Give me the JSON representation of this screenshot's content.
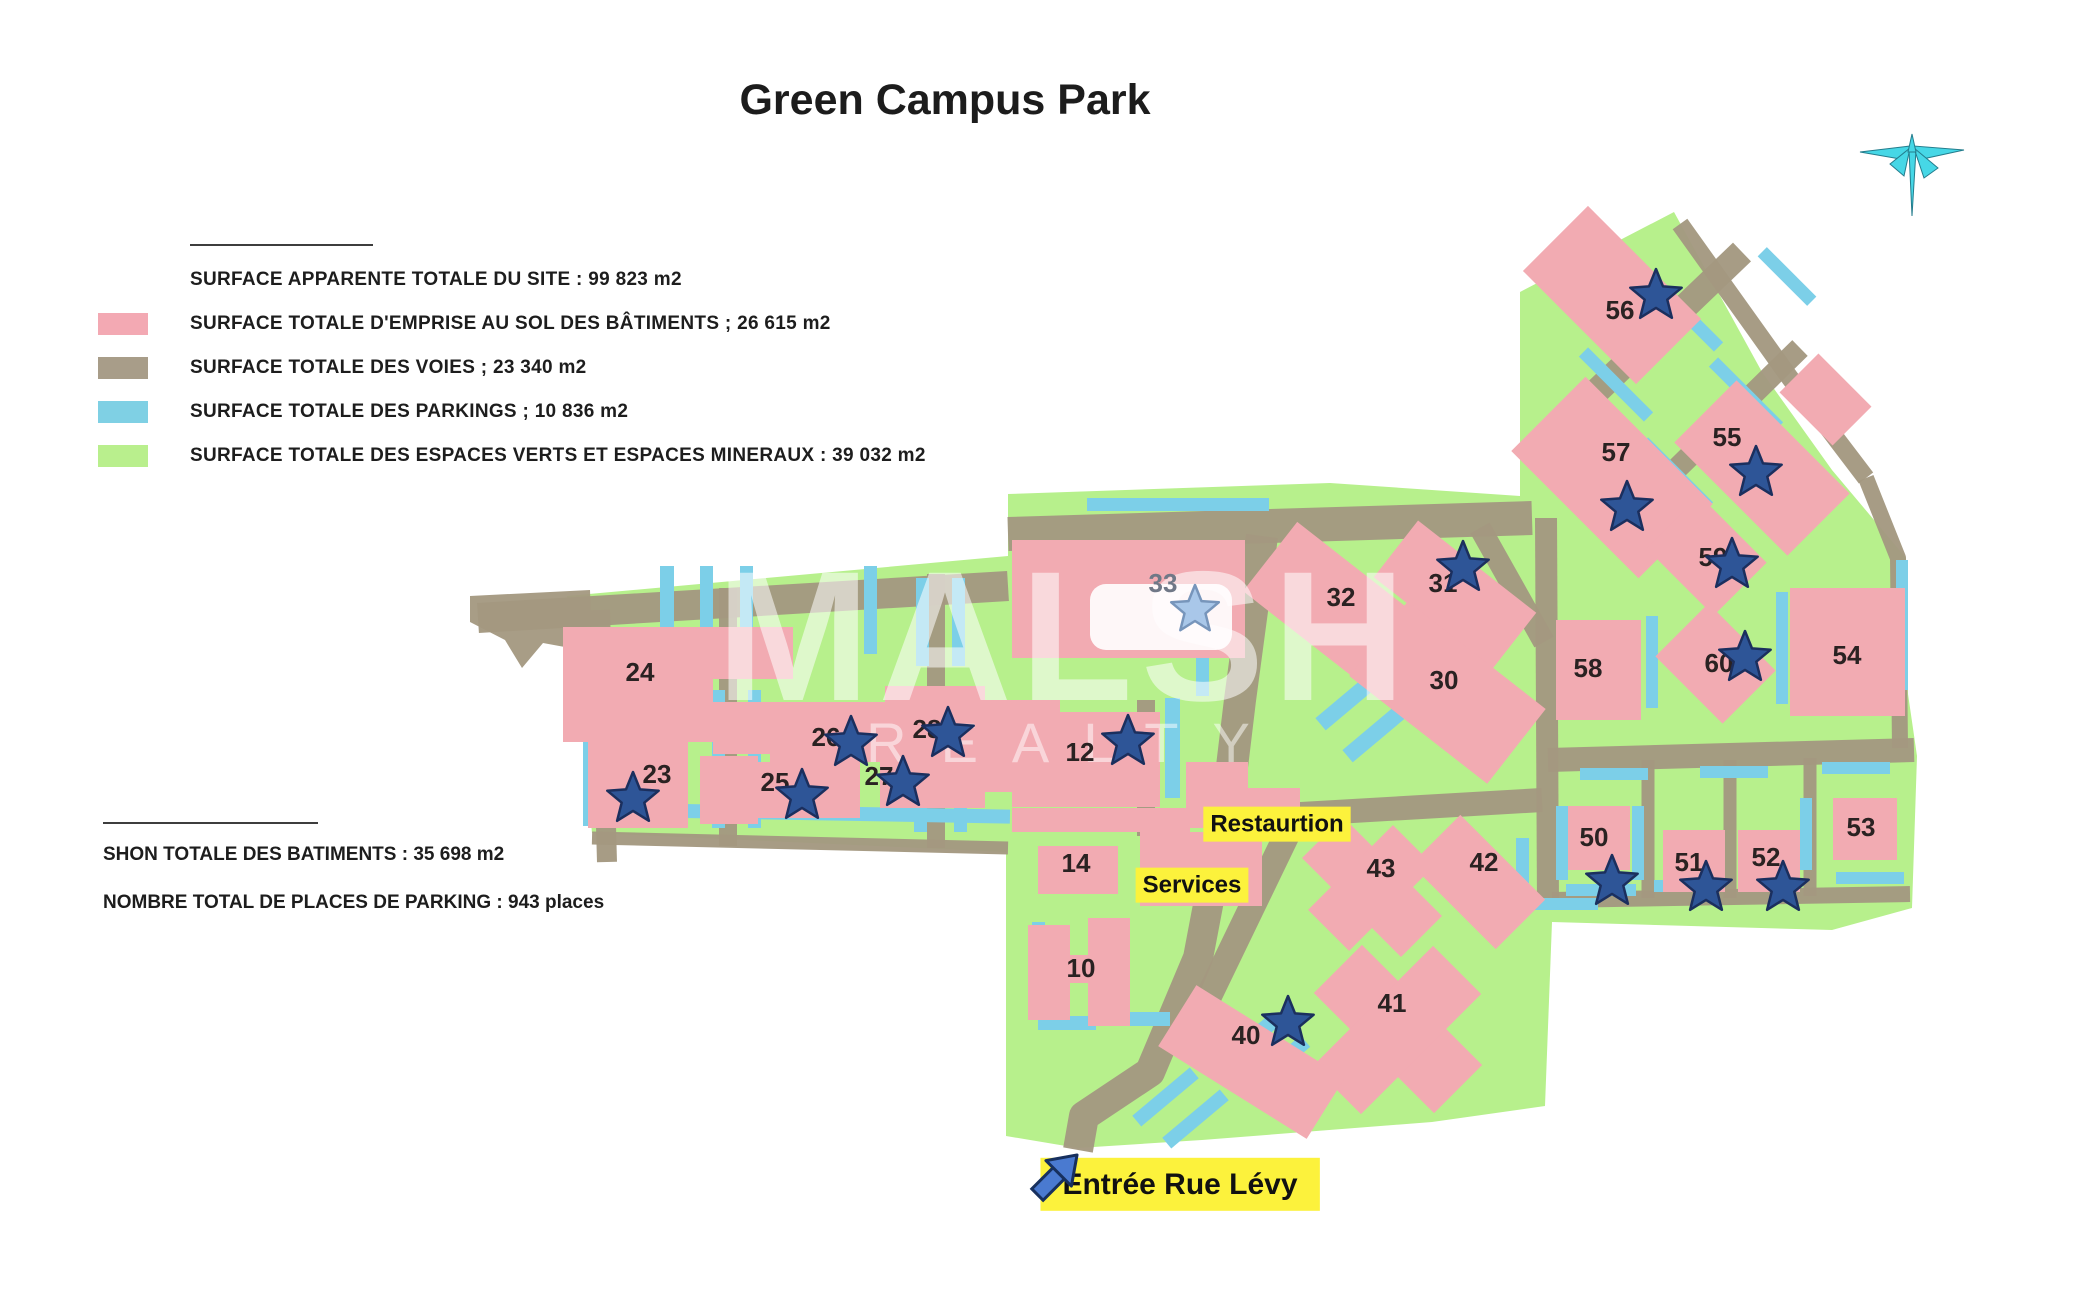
{
  "title": "Green Campus Park",
  "legend": {
    "site": "SURFACE APPARENTE TOTALE DU SITE : 99 823 m2",
    "items": [
      {
        "color": "#f3a9b3",
        "label": "SURFACE TOTALE D'EMPRISE AU SOL DES BÂTIMENTS ; 26 615  m2"
      },
      {
        "color": "#a89d89",
        "label": "SURFACE TOTALE DES VOIES ; 23 340  m2"
      },
      {
        "color": "#7fd0e4",
        "label": "SURFACE TOTALE DES PARKINGS ; 10 836  m2"
      },
      {
        "color": "#b9ef8d",
        "label": "SURFACE TOTALE DES ESPACES VERTS ET ESPACES MINERAUX : 39 032  m2"
      }
    ]
  },
  "stats": {
    "shon": "SHON TOTALE DES BATIMENTS : 35 698 m2",
    "parking": "NOMBRE TOTAL DE PLACES DE PARKING : 943 places"
  },
  "watermark": {
    "line1": "MALSH",
    "line2": "REALTY"
  },
  "map": {
    "colors": {
      "green": "#b7f08c",
      "road": "#a39880",
      "building": "#f2abb2",
      "parking": "#7ccfe8",
      "star": "#2e5597",
      "star_stroke": "#1b2f5e",
      "star_light": "#a9c7e9",
      "star_light_stroke": "#7795bb",
      "tag_bg": "#fcf23c",
      "tag_text": "#111111",
      "label_text": "#2a2222",
      "label_muted": "#707887",
      "arrow": "#4a7ad0",
      "arrow_stroke": "#17305e",
      "compass": "#46d7e6",
      "compass_stroke": "#237c8c"
    },
    "green_outline": [
      [
        567,
        596
      ],
      [
        1008,
        556
      ],
      [
        1008,
        494
      ],
      [
        1330,
        483
      ],
      [
        1520,
        496
      ],
      [
        1520,
        292
      ],
      [
        1674,
        212
      ],
      [
        1762,
        372
      ],
      [
        1832,
        470
      ],
      [
        1906,
        558
      ],
      [
        1908,
        694
      ],
      [
        1917,
        756
      ],
      [
        1912,
        908
      ],
      [
        1832,
        930
      ],
      [
        1552,
        922
      ],
      [
        1545,
        1106
      ],
      [
        1432,
        1122
      ],
      [
        1202,
        1140
      ],
      [
        1078,
        1148
      ],
      [
        1006,
        1136
      ],
      [
        1006,
        852
      ],
      [
        592,
        833
      ],
      [
        573,
        640
      ]
    ],
    "road_stub": [
      [
        470,
        596
      ],
      [
        590,
        590
      ],
      [
        592,
        652
      ],
      [
        543,
        643
      ],
      [
        522,
        668
      ],
      [
        505,
        640
      ],
      [
        470,
        622
      ]
    ],
    "roads": [
      {
        "pts": [
          [
            478,
            618
          ],
          [
            1008,
            586
          ]
        ],
        "w": 30
      },
      {
        "pts": [
          [
            600,
            610
          ],
          [
            607,
            862
          ]
        ],
        "w": 20
      },
      {
        "pts": [
          [
            728,
            588
          ],
          [
            728,
            846
          ]
        ],
        "w": 18
      },
      {
        "pts": [
          [
            936,
            574
          ],
          [
            936,
            848
          ]
        ],
        "w": 18
      },
      {
        "pts": [
          [
            592,
            838
          ],
          [
            1008,
            848
          ]
        ],
        "w": 13
      },
      {
        "pts": [
          [
            1008,
            534
          ],
          [
            1532,
            518
          ]
        ],
        "w": 34
      },
      {
        "pts": [
          [
            1262,
            536
          ],
          [
            1240,
            700
          ],
          [
            1228,
            800
          ]
        ],
        "w": 32
      },
      {
        "pts": [
          [
            1228,
            800
          ],
          [
            1198,
            958
          ],
          [
            1150,
            1072
          ],
          [
            1084,
            1116
          ],
          [
            1078,
            1150
          ]
        ],
        "w": 30
      },
      {
        "pts": [
          [
            1232,
            818
          ],
          [
            1542,
            800
          ]
        ],
        "w": 24
      },
      {
        "pts": [
          [
            1294,
            820
          ],
          [
            1182,
            1052
          ]
        ],
        "w": 26
      },
      {
        "pts": [
          [
            1146,
            700
          ],
          [
            1146,
            836
          ]
        ],
        "w": 18
      },
      {
        "pts": [
          [
            1480,
            528
          ],
          [
            1544,
            642
          ]
        ],
        "w": 22
      },
      {
        "pts": [
          [
            1548,
            438
          ],
          [
            1742,
            252
          ]
        ],
        "w": 26
      },
      {
        "pts": [
          [
            1608,
            536
          ],
          [
            1800,
            348
          ]
        ],
        "w": 22
      },
      {
        "pts": [
          [
            1680,
            224
          ],
          [
            1790,
            378
          ],
          [
            1866,
            478
          ]
        ],
        "w": 18
      },
      {
        "pts": [
          [
            1546,
            518
          ],
          [
            1548,
            906
          ]
        ],
        "w": 22
      },
      {
        "pts": [
          [
            1866,
            478
          ],
          [
            1898,
            558
          ],
          [
            1900,
            748
          ]
        ],
        "w": 16
      },
      {
        "pts": [
          [
            1548,
            760
          ],
          [
            1914,
            750
          ]
        ],
        "w": 24
      },
      {
        "pts": [
          [
            1552,
            900
          ],
          [
            1910,
            894
          ]
        ],
        "w": 16
      },
      {
        "pts": [
          [
            1648,
            760
          ],
          [
            1648,
            898
          ]
        ],
        "w": 13
      },
      {
        "pts": [
          [
            1730,
            760
          ],
          [
            1730,
            898
          ]
        ],
        "w": 13
      },
      {
        "pts": [
          [
            1810,
            758
          ],
          [
            1810,
            896
          ]
        ],
        "w": 13
      }
    ],
    "parkings": [
      [
        583,
        694,
        14,
        132,
        0
      ],
      [
        660,
        566,
        14,
        92,
        0
      ],
      [
        700,
        566,
        13,
        92,
        0
      ],
      [
        740,
        566,
        13,
        92,
        0
      ],
      [
        712,
        690,
        13,
        138,
        0
      ],
      [
        748,
        690,
        13,
        138,
        0
      ],
      [
        864,
        566,
        13,
        88,
        0
      ],
      [
        916,
        578,
        13,
        88,
        0
      ],
      [
        952,
        578,
        13,
        88,
        0
      ],
      [
        914,
        690,
        13,
        142,
        0
      ],
      [
        954,
        690,
        13,
        142,
        0
      ],
      [
        592,
        806,
        418,
        14,
        1
      ],
      [
        1087,
        498,
        182,
        13,
        0
      ],
      [
        1165,
        698,
        15,
        100,
        0
      ],
      [
        1196,
        640,
        13,
        56,
        0
      ],
      [
        1303,
        668,
        150,
        16,
        -40
      ],
      [
        1330,
        700,
        150,
        16,
        -40
      ],
      [
        1516,
        838,
        13,
        70,
        0
      ],
      [
        1528,
        898,
        70,
        12,
        0
      ],
      [
        1203,
        1038,
        82,
        15,
        -40
      ],
      [
        1233,
        1060,
        82,
        15,
        -40
      ],
      [
        1128,
        1090,
        75,
        14,
        -40
      ],
      [
        1158,
        1112,
        75,
        14,
        -40
      ],
      [
        1038,
        1016,
        58,
        14,
        0
      ],
      [
        1112,
        1012,
        58,
        14,
        0
      ],
      [
        1032,
        922,
        13,
        52,
        0
      ],
      [
        1570,
        378,
        92,
        13,
        45
      ],
      [
        1640,
        308,
        92,
        13,
        45
      ],
      [
        1700,
        388,
        92,
        13,
        45
      ],
      [
        1630,
        468,
        92,
        13,
        45
      ],
      [
        1752,
        270,
        70,
        13,
        45
      ],
      [
        1776,
        592,
        12,
        112,
        0
      ],
      [
        1646,
        616,
        12,
        92,
        0
      ],
      [
        1556,
        806,
        12,
        74,
        0
      ],
      [
        1632,
        806,
        12,
        74,
        0
      ],
      [
        1566,
        884,
        70,
        12,
        0
      ],
      [
        1800,
        798,
        12,
        72,
        0
      ],
      [
        1836,
        872,
        68,
        12,
        0
      ],
      [
        1580,
        768,
        68,
        12,
        0
      ],
      [
        1700,
        766,
        68,
        12,
        0
      ],
      [
        1822,
        762,
        68,
        12,
        0
      ],
      [
        1654,
        880,
        62,
        12,
        0
      ],
      [
        1896,
        560,
        12,
        130,
        0
      ]
    ],
    "buildings": [
      [
        563,
        627,
        150,
        115,
        0
      ],
      [
        713,
        627,
        80,
        52,
        0
      ],
      [
        713,
        702,
        78,
        52,
        0
      ],
      [
        588,
        742,
        100,
        86,
        0
      ],
      [
        700,
        756,
        58,
        68,
        0
      ],
      [
        770,
        702,
        115,
        60,
        0
      ],
      [
        885,
        686,
        100,
        74,
        0
      ],
      [
        745,
        762,
        115,
        56,
        0
      ],
      [
        880,
        748,
        105,
        60,
        0
      ],
      [
        975,
        700,
        85,
        92,
        0
      ],
      [
        1012,
        540,
        233,
        118,
        0
      ],
      [
        1012,
        712,
        148,
        95,
        0
      ],
      [
        1012,
        808,
        178,
        24,
        0
      ],
      [
        1186,
        762,
        62,
        66,
        0
      ],
      [
        1228,
        788,
        72,
        48,
        0
      ],
      [
        1038,
        846,
        80,
        48,
        0
      ],
      [
        1140,
        832,
        122,
        74,
        0
      ],
      [
        1028,
        925,
        42,
        95,
        0
      ],
      [
        1088,
        918,
        42,
        108,
        0
      ],
      [
        1068,
        955,
        42,
        28,
        0
      ],
      [
        1250,
        571,
        190,
        88,
        38
      ],
      [
        1380,
        559,
        150,
        72,
        38
      ],
      [
        1360,
        645,
        175,
        95,
        38
      ],
      [
        1302,
        858,
        140,
        58,
        45
      ],
      [
        1342,
        828,
        58,
        120,
        45
      ],
      [
        1418,
        847,
        120,
        70,
        45
      ],
      [
        1313,
        995,
        170,
        68,
        45
      ],
      [
        1363,
        945,
        68,
        170,
        45
      ],
      [
        1164,
        1026,
        175,
        72,
        32
      ],
      [
        1532,
        249,
        160,
        92,
        45
      ],
      [
        1522,
        425,
        180,
        105,
        45
      ],
      [
        1682,
        424,
        160,
        88,
        45
      ],
      [
        1788,
        372,
        75,
        55,
        45
      ],
      [
        1659,
        518,
        95,
        75,
        45
      ],
      [
        1668,
        626,
        95,
        75,
        45
      ],
      [
        1556,
        620,
        85,
        100,
        0
      ],
      [
        1790,
        588,
        115,
        128,
        0
      ],
      [
        1568,
        806,
        62,
        64,
        0
      ],
      [
        1663,
        830,
        62,
        62,
        0
      ],
      [
        1738,
        830,
        62,
        62,
        0
      ],
      [
        1833,
        798,
        64,
        62,
        0
      ]
    ],
    "courtyards": [
      [
        1090,
        584,
        142,
        66
      ]
    ],
    "labels": [
      {
        "t": "24",
        "x": 640,
        "y": 672
      },
      {
        "t": "23",
        "x": 657,
        "y": 774
      },
      {
        "t": "25",
        "x": 775,
        "y": 782
      },
      {
        "t": "26",
        "x": 826,
        "y": 737
      },
      {
        "t": "27",
        "x": 879,
        "y": 776
      },
      {
        "t": "28",
        "x": 927,
        "y": 729
      },
      {
        "t": "12",
        "x": 1080,
        "y": 752
      },
      {
        "t": "33",
        "x": 1163,
        "y": 583,
        "muted": true
      },
      {
        "t": "14",
        "x": 1076,
        "y": 863
      },
      {
        "t": "10",
        "x": 1081,
        "y": 968
      },
      {
        "t": "32",
        "x": 1341,
        "y": 597
      },
      {
        "t": "31",
        "x": 1443,
        "y": 583
      },
      {
        "t": "30",
        "x": 1444,
        "y": 680
      },
      {
        "t": "43",
        "x": 1381,
        "y": 868
      },
      {
        "t": "42",
        "x": 1484,
        "y": 862
      },
      {
        "t": "41",
        "x": 1392,
        "y": 1003
      },
      {
        "t": "40",
        "x": 1246,
        "y": 1035
      },
      {
        "t": "58",
        "x": 1588,
        "y": 668
      },
      {
        "t": "54",
        "x": 1847,
        "y": 655
      },
      {
        "t": "53",
        "x": 1861,
        "y": 827
      },
      {
        "t": "50",
        "x": 1594,
        "y": 837
      },
      {
        "t": "51",
        "x": 1689,
        "y": 862
      },
      {
        "t": "52",
        "x": 1766,
        "y": 857
      },
      {
        "t": "55",
        "x": 1727,
        "y": 437
      },
      {
        "t": "56",
        "x": 1620,
        "y": 310
      },
      {
        "t": "57",
        "x": 1616,
        "y": 452
      },
      {
        "t": "59",
        "x": 1713,
        "y": 557
      },
      {
        "t": "60",
        "x": 1719,
        "y": 663
      }
    ],
    "stars": [
      {
        "x": 633,
        "y": 799
      },
      {
        "x": 802,
        "y": 796
      },
      {
        "x": 851,
        "y": 743
      },
      {
        "x": 903,
        "y": 783
      },
      {
        "x": 948,
        "y": 734
      },
      {
        "x": 1128,
        "y": 742
      },
      {
        "x": 1195,
        "y": 610,
        "light": true
      },
      {
        "x": 1463,
        "y": 568
      },
      {
        "x": 1288,
        "y": 1023
      },
      {
        "x": 1612,
        "y": 882
      },
      {
        "x": 1706,
        "y": 888
      },
      {
        "x": 1783,
        "y": 888
      },
      {
        "x": 1756,
        "y": 473
      },
      {
        "x": 1656,
        "y": 296
      },
      {
        "x": 1627,
        "y": 508
      },
      {
        "x": 1732,
        "y": 565
      },
      {
        "x": 1745,
        "y": 658
      }
    ],
    "tags": [
      {
        "t": "Restaurtion",
        "x": 1277,
        "y": 823,
        "fs": 24,
        "px": 7,
        "py": 4
      },
      {
        "t": "Services",
        "x": 1192,
        "y": 884,
        "fs": 24,
        "px": 7,
        "py": 4
      },
      {
        "t": "Entrée Rue Lévy",
        "x": 1180,
        "y": 1183,
        "fs": 30,
        "px": 22,
        "py": 10
      }
    ],
    "entry_arrow": {
      "x": 1053,
      "y": 1179
    },
    "compass": {
      "x": 1912,
      "y": 158
    }
  }
}
